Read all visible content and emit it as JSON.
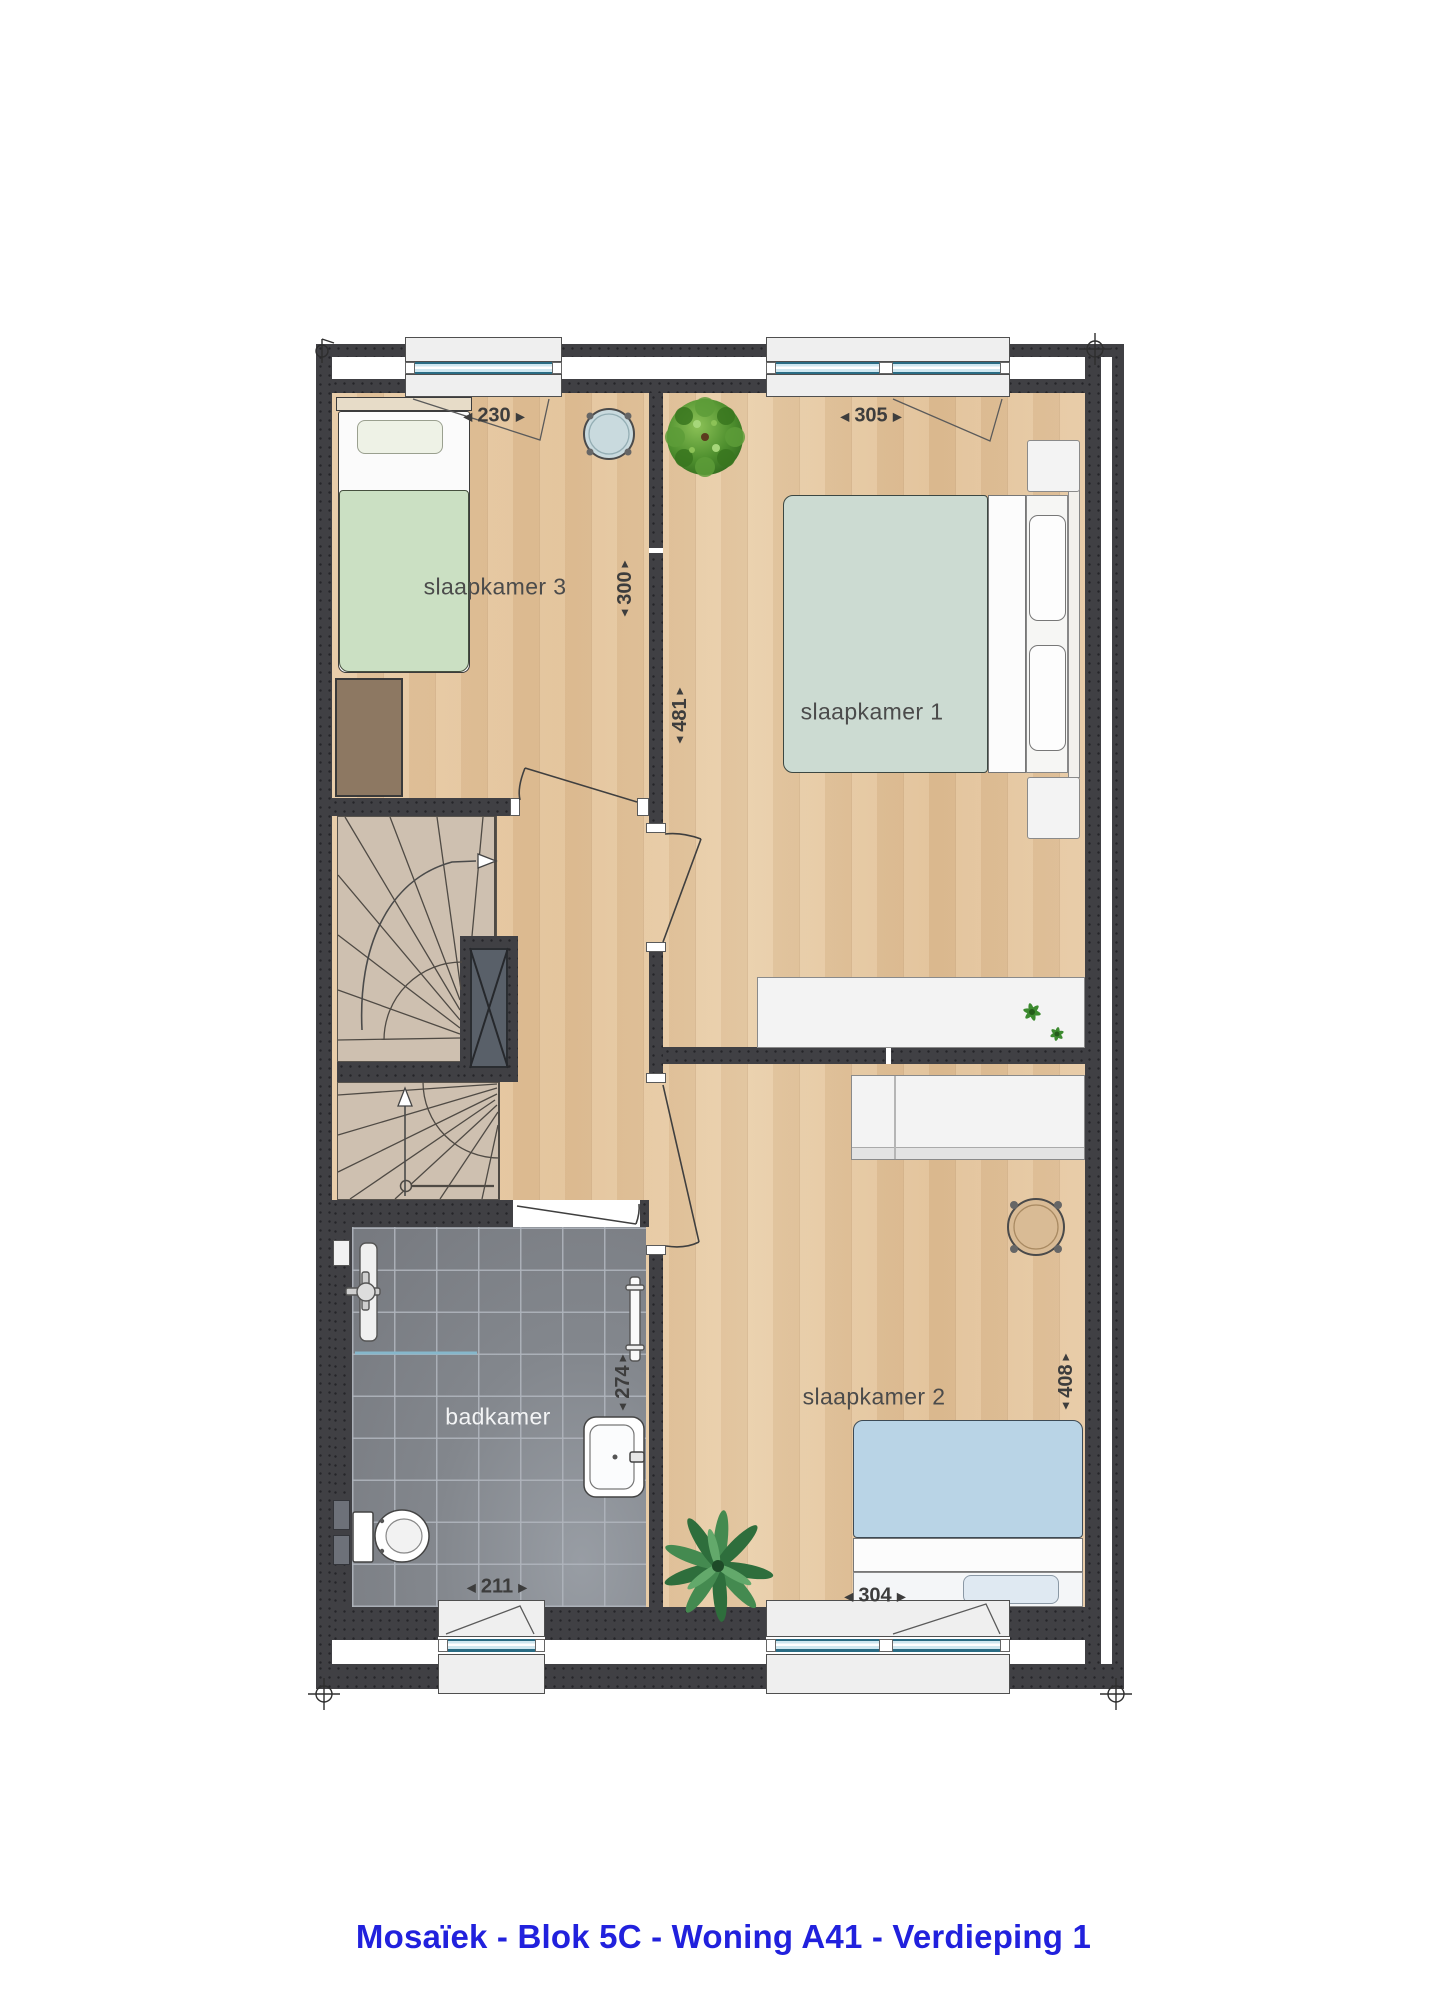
{
  "title": "Mosaïek - Blok 5C - Woning A41 - Verdieping 1",
  "rooms": {
    "bedroom1": {
      "label": "slaapkamer 1",
      "width": "305",
      "depth": "481"
    },
    "bedroom2": {
      "label": "slaapkamer 2",
      "width": "304",
      "depth": "408"
    },
    "bedroom3": {
      "label": "slaapkamer 3",
      "width": "230",
      "depth": "300"
    },
    "bathroom": {
      "label": "badkamer",
      "width": "211",
      "depth": "274"
    }
  },
  "glyphs": {
    "arrow_left": "◀",
    "arrow_right": "▶",
    "arrow_up": "▲",
    "arrow_down": "▼"
  },
  "colors": {
    "wall": "#404044",
    "wood": "#e5c6a0",
    "tile": "#83878d",
    "stair": "#cec0b0",
    "title_blue": "#2121dd",
    "duvet_green": "#cbe0c3",
    "duvet_sage": "#ccdbd2",
    "duvet_blue": "#b9d4e6"
  }
}
